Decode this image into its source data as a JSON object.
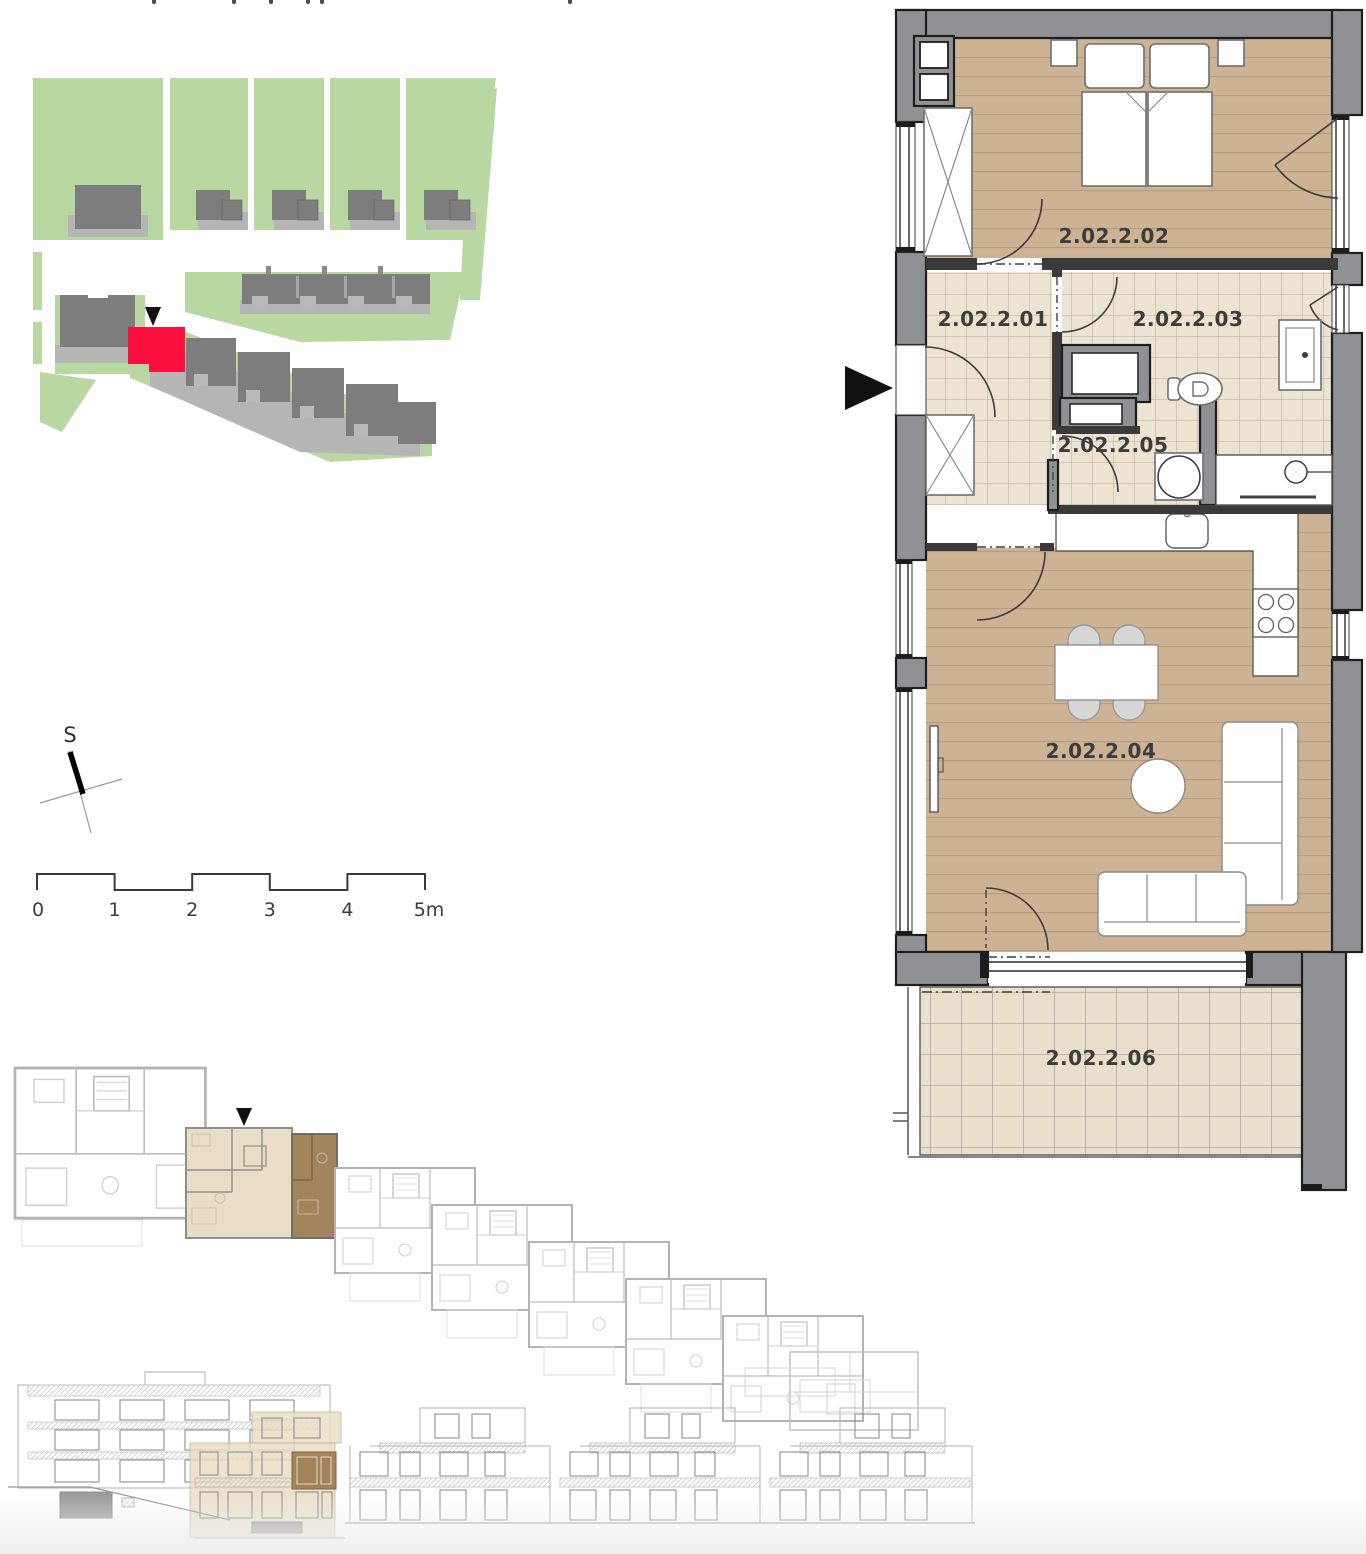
{
  "compass": {
    "label": "S"
  },
  "scale_bar": {
    "labels": [
      "0",
      "1",
      "2",
      "3",
      "4",
      "5m"
    ]
  },
  "floor_plan": {
    "rooms": [
      {
        "code": "2.02.2.01"
      },
      {
        "code": "2.02.2.02"
      },
      {
        "code": "2.02.2.03"
      },
      {
        "code": "2.02.2.04"
      },
      {
        "code": "2.02.2.05"
      },
      {
        "code": "2.02.2.06"
      }
    ]
  },
  "colors": {
    "wood": "#cdb294",
    "wood_line": "#b69c7c",
    "tile": "#ede3d2",
    "tile_line": "#bcae94",
    "tile_large": "#e9dfcc",
    "wall": "#8f9194",
    "wall_dark": "#3a3a3a",
    "outline": "#1d1d1d",
    "site_green": "#b9d7a1",
    "site_building": "#7d7d7d",
    "site_building_light": "#b5b5b5",
    "unit_red": "#fb0f3f",
    "overview_beige": "#e9ddc6",
    "overview_brown": "#a3835c",
    "elevation_line": "#b2b2b2",
    "label_text": "#3c3c3c"
  }
}
